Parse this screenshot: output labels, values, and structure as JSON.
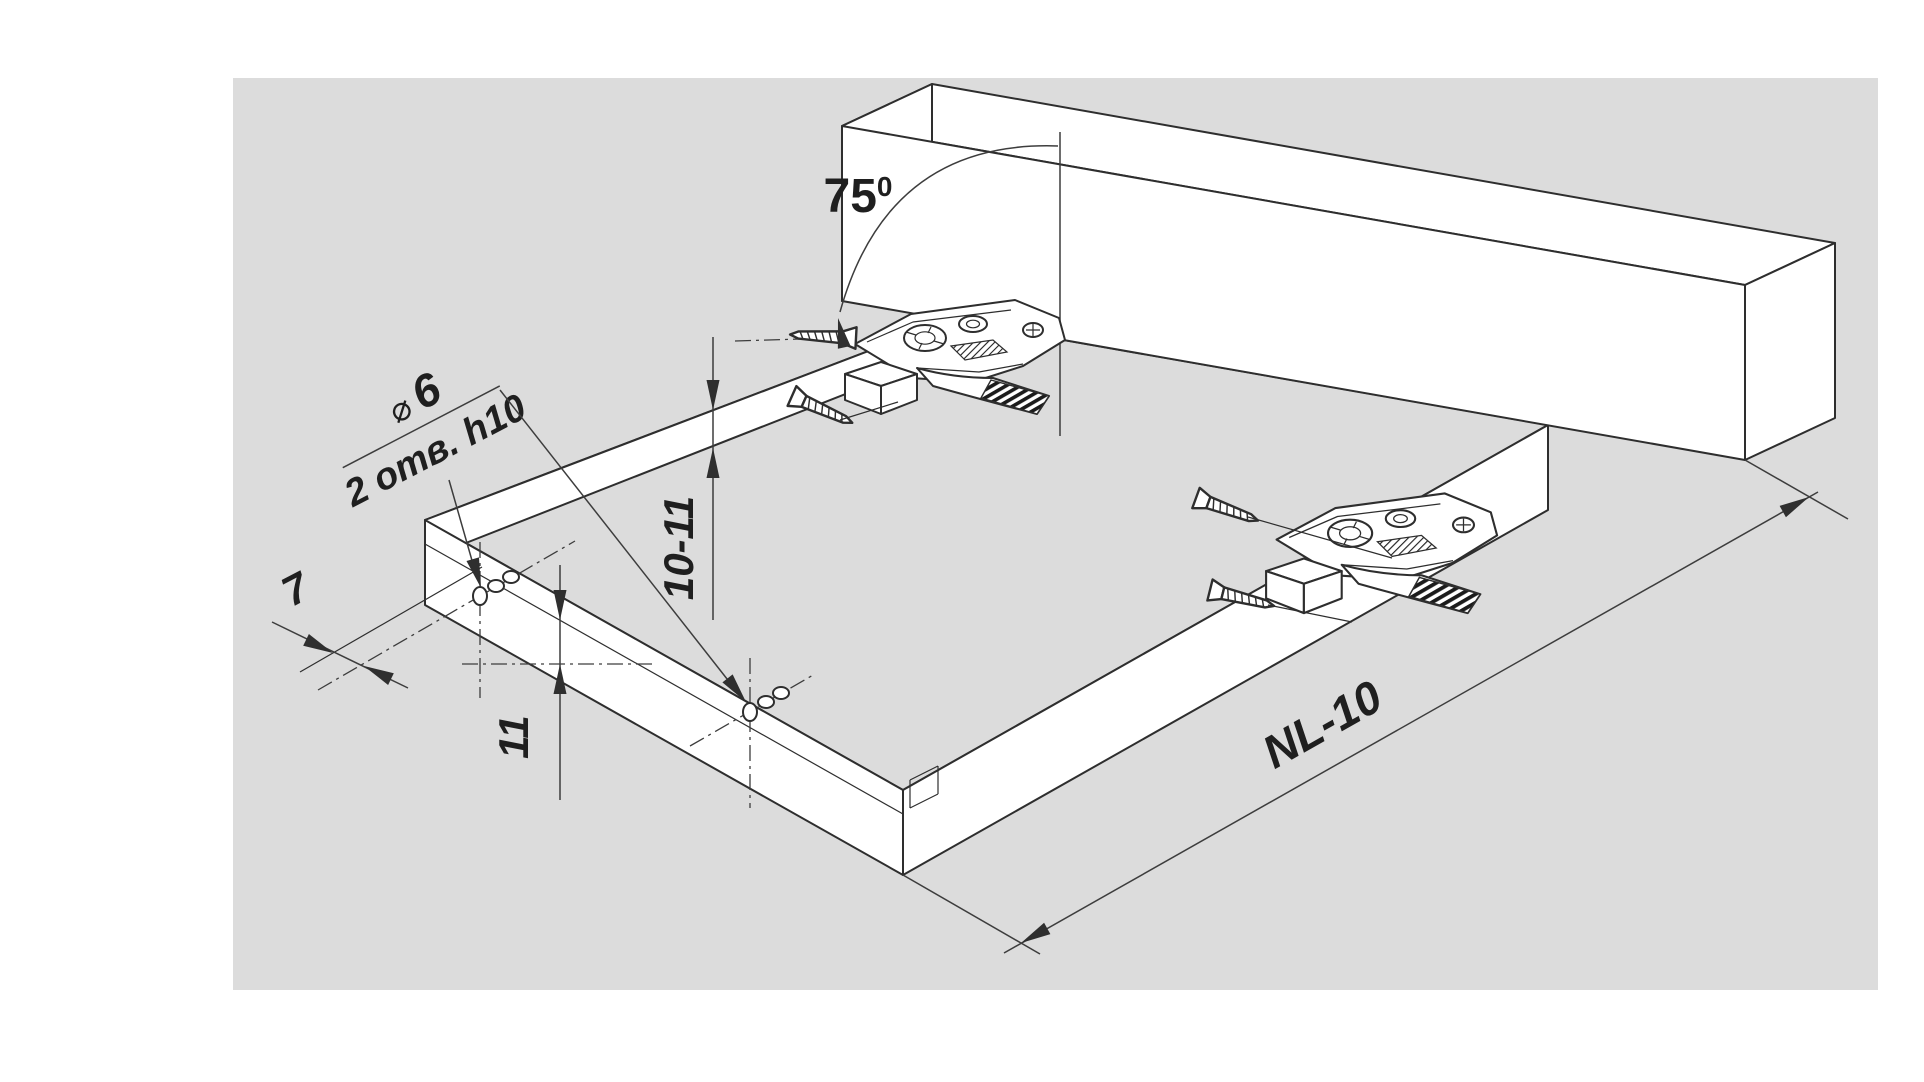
{
  "canvas": {
    "background": "#dcdcdc",
    "page_background": "#ffffff",
    "line_color": "#2e2e2e",
    "dimension_color": "#3d3d3d"
  },
  "annotations": {
    "angle": {
      "value": "75",
      "sup": "0"
    },
    "hole_callout": {
      "diameter_symbol": "⌀",
      "diameter_value": "6",
      "holes_note": "2 отв. h10"
    },
    "dim_edge_offset": "7",
    "dim_height_range": "10-11",
    "dim_height": "11",
    "dim_length": "NL-10"
  }
}
